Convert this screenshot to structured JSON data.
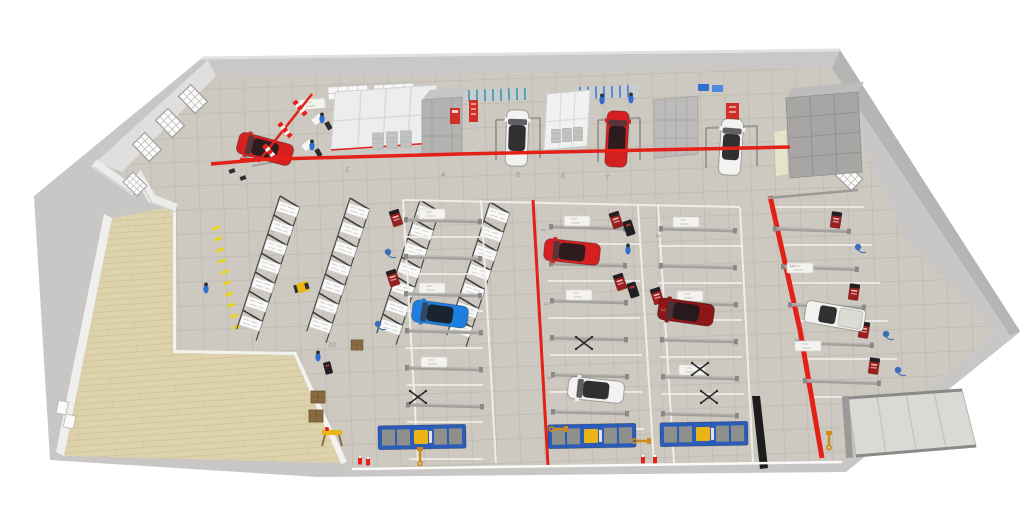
{
  "labels": {
    "top_bay_numbers": [
      "1",
      "4",
      "5",
      "6",
      "7"
    ],
    "racking_aisle_number": "10",
    "side_bay_markers": [
      "3",
      "3",
      "3",
      "3",
      "3",
      "3",
      "3"
    ]
  },
  "colors": {
    "page_bg": "#ffffff",
    "apron": "#c8c7c5",
    "wall_light": "#ececea",
    "wall_mid": "#c9c8c6",
    "wall_dark": "#b6b5b3",
    "floor_tile": "#cdc9c1",
    "floor_tile_line": "#c1bdb5",
    "wood_floor": "#ddd2ac",
    "wood_floor_line": "#d2c69c",
    "safety_red": "#e32119",
    "red_car": "#d42020",
    "dark_red_car": "#8e1616",
    "blue_car": "#1d7fe0",
    "white_car": "#f2f2f1",
    "booth_white": "#f0f1f0",
    "structure_grey": "#a7a6a4",
    "rack_frame": "#3c3c3c",
    "rack_load": "#ffffff",
    "platform_blue": "#2b5cb8",
    "equipment_yellow": "#eab616",
    "crane_orange": "#cf8a1d",
    "worker_blue": "#2f6fd0",
    "cart_red": "#9c1f1f",
    "cart_black": "#202024",
    "marking_yellow": "#e8d227"
  },
  "objects": {
    "vehicles": [
      "red sedan (corner bay)",
      "white SUV (top bay)",
      "red SUV (top bay)",
      "white crossover (top right bay)",
      "red sedan (center bay)",
      "dark red sedan (center bay)",
      "blue sedan (left bay)",
      "white sedan (bottom center bay)",
      "white pickup (right bay)"
    ],
    "equipment": [
      "pallet racking rows",
      "order picker forklift",
      "prep station lifts",
      "alignment platforms",
      "engine cranes",
      "tool carts",
      "striped barrier",
      "fire extinguishers"
    ],
    "rooms": [
      "paint booth",
      "mixing room",
      "paint booth 2",
      "plant room",
      "wood-floor storage hall"
    ]
  }
}
